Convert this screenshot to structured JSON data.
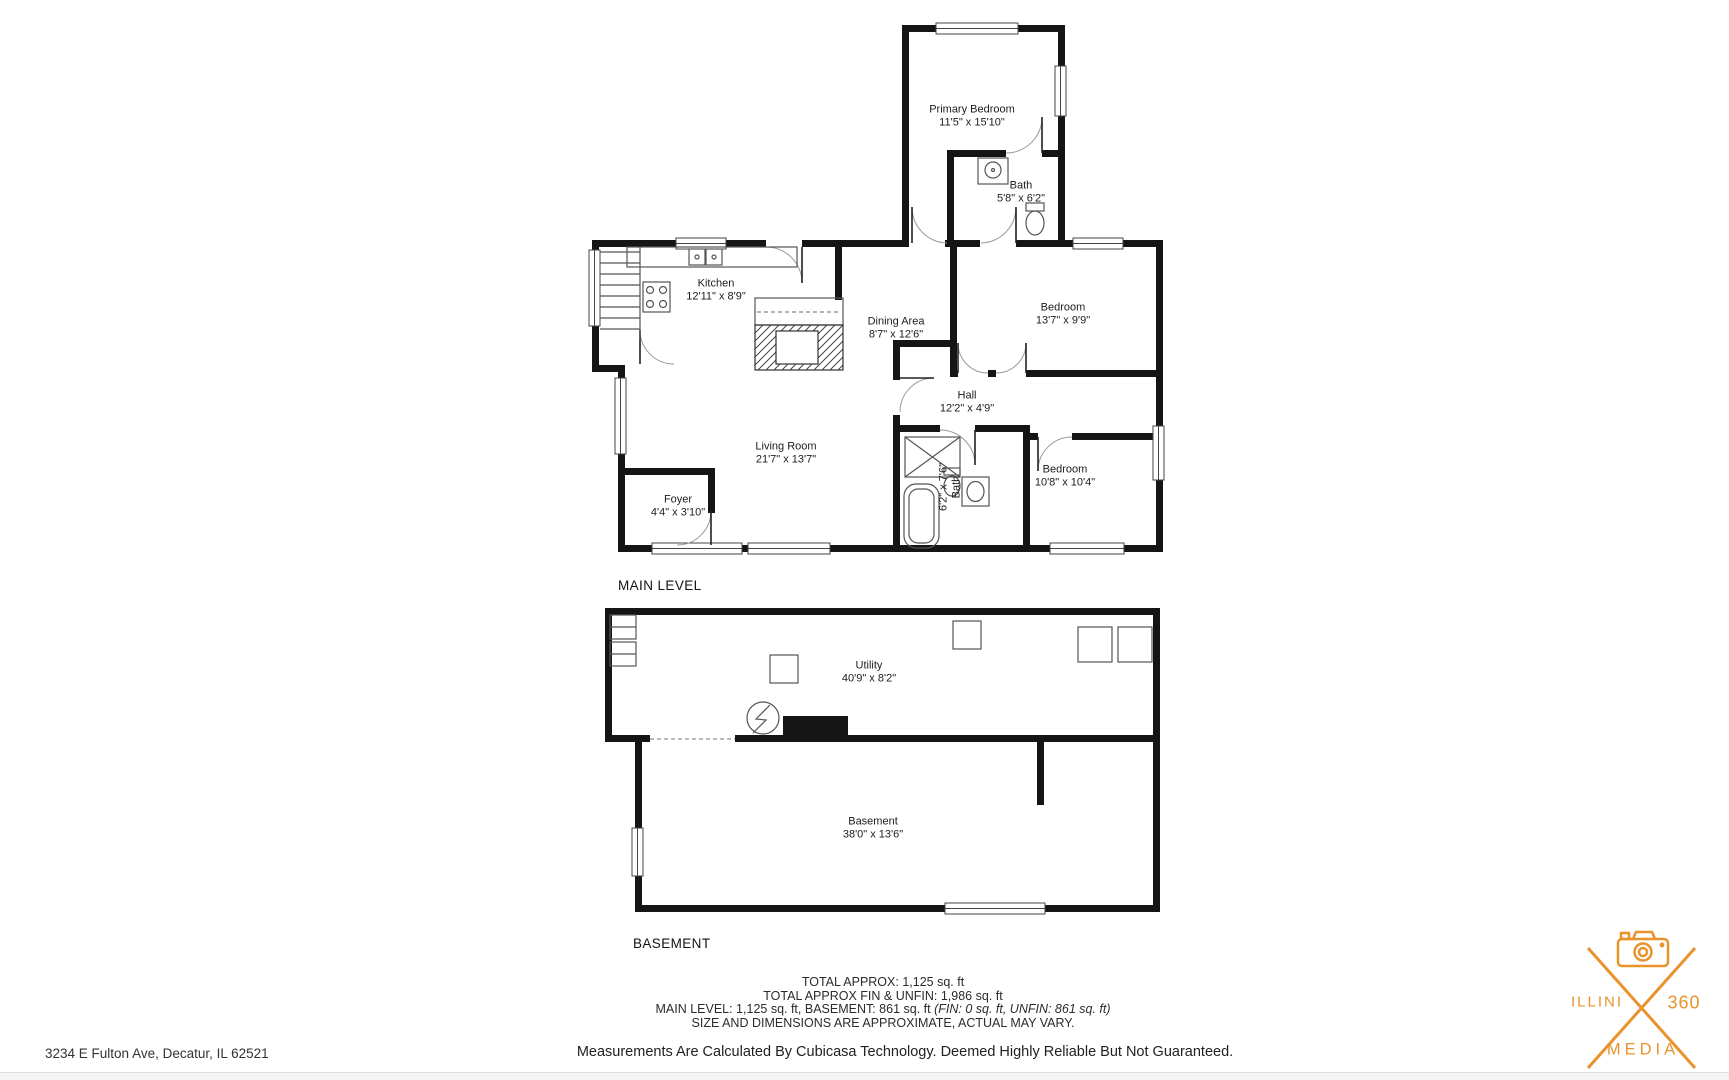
{
  "main_level": {
    "section_label": "MAIN LEVEL",
    "rooms": [
      {
        "name": "Primary Bedroom",
        "dims": "11'5\" x 15'10\""
      },
      {
        "name": "Bath",
        "dims": "5'8\" x 6'2\""
      },
      {
        "name": "Kitchen",
        "dims": "12'11\" x 8'9\""
      },
      {
        "name": "Dining Area",
        "dims": "8'7\" x 12'6\""
      },
      {
        "name": "Bedroom",
        "dims": "13'7\" x 9'9\""
      },
      {
        "name": "Hall",
        "dims": "12'2\" x 4'9\""
      },
      {
        "name": "Living Room",
        "dims": "21'7\" x 13'7\""
      },
      {
        "name": "Foyer",
        "dims": "4'4\" x 3'10\""
      },
      {
        "name": "Bath",
        "dims": "6'2\" x 7'6\""
      },
      {
        "name": "Bedroom",
        "dims": "10'8\" x 10'4\""
      }
    ]
  },
  "basement": {
    "section_label": "BASEMENT",
    "rooms": [
      {
        "name": "Utility",
        "dims": "40'9\" x 8'2\""
      },
      {
        "name": "Basement",
        "dims": "38'0\" x 13'6\""
      }
    ]
  },
  "summary": {
    "line1": "TOTAL APPROX: 1,125 sq. ft",
    "line2": "TOTAL APPROX FIN & UNFIN: 1,986 sq. ft",
    "line3_regular": "MAIN LEVEL: 1,125 sq. ft, BASEMENT: 861 sq. ft ",
    "line3_italic": "(FIN: 0 sq. ft, UNFIN: 861 sq. ft)",
    "line4": "SIZE AND DIMENSIONS ARE APPROXIMATE, ACTUAL MAY VARY.",
    "disclaimer": "Measurements Are Calculated By Cubicasa Technology. Deemed Highly Reliable But Not Guaranteed."
  },
  "footer": {
    "address": "3234 E Fulton Ave, Decatur, IL 62521"
  },
  "logo": {
    "name_left": "ILLINI",
    "name_right": "360",
    "name_bottom": "MEDIA",
    "color": "#E8932C",
    "icon": "camera-icon"
  }
}
